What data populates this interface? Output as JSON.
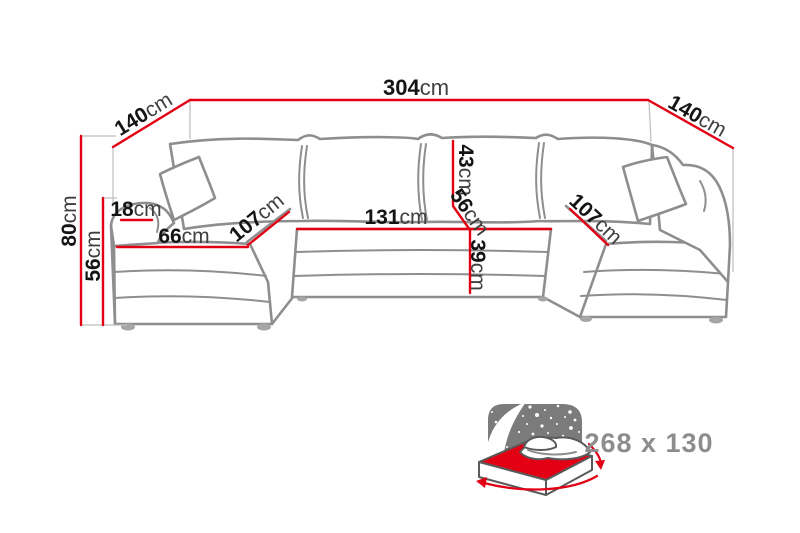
{
  "diagram": {
    "type": "u-shaped-sofa-dimension-diagram",
    "dimensions": {
      "total_width": {
        "num": "304",
        "unit": "cm"
      },
      "left_arm_depth": {
        "num": "140",
        "unit": "cm"
      },
      "right_arm_depth": {
        "num": "140",
        "unit": "cm"
      },
      "total_height": {
        "num": "80",
        "unit": "cm"
      },
      "left_seat_height": {
        "num": "56",
        "unit": "cm"
      },
      "left_armrest_width": {
        "num": "18",
        "unit": "cm"
      },
      "left_chaise_width": {
        "num": "66",
        "unit": "cm"
      },
      "left_chaise_length": {
        "num": "107",
        "unit": "cm"
      },
      "center_seat_width": {
        "num": "131",
        "unit": "cm"
      },
      "backrest_cushion_height": {
        "num": "43",
        "unit": "cm"
      },
      "center_seat_depth": {
        "num": "56",
        "unit": "cm"
      },
      "center_seat_height": {
        "num": "39",
        "unit": "cm"
      },
      "right_chaise_length": {
        "num": "107",
        "unit": "cm"
      }
    },
    "sleeping_area": {
      "size_label": "268 x 130"
    },
    "colors": {
      "dimension_line": "#e30015",
      "sofa_outline": "#8e8e8e",
      "label_number": "#141414",
      "label_unit": "#3f3f3f",
      "sleeping_icon_panel": "#7b7b7b",
      "sleeping_mattress": "#e30015",
      "sleeping_text": "#8d8d8d"
    }
  }
}
